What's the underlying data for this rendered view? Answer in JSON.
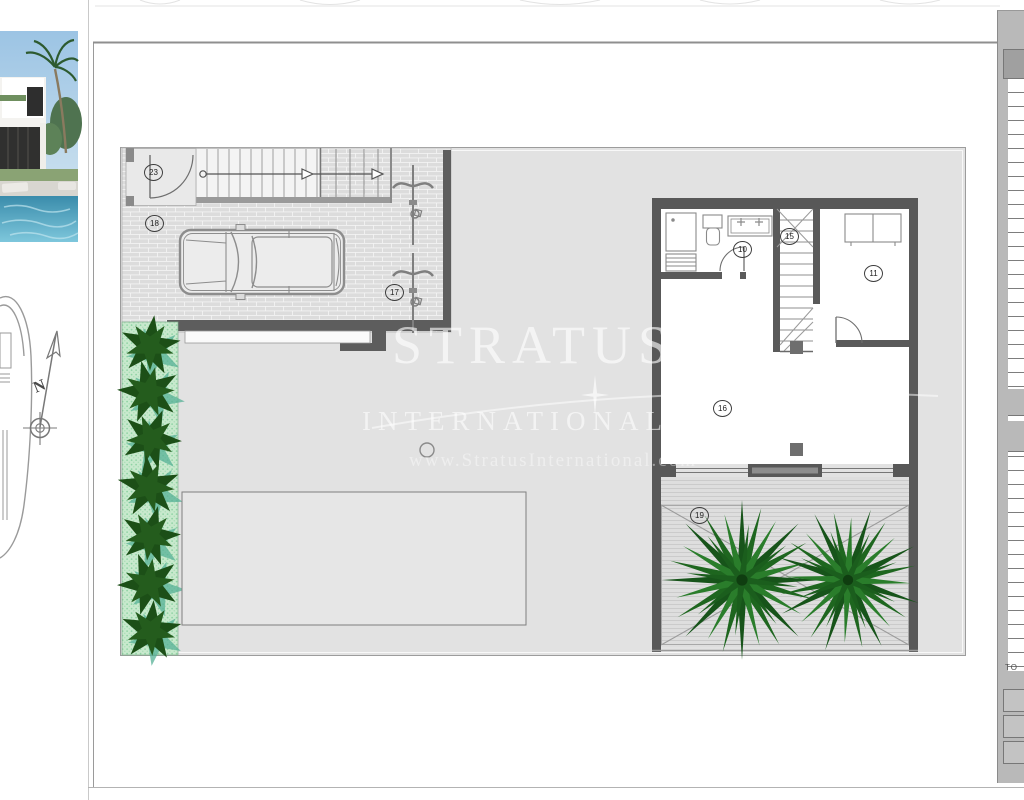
{
  "watermark": {
    "line1": "STRATUS",
    "line2": "INTERNATIONAL",
    "line3": "www.StratusInternational.com"
  },
  "compass": {
    "north_label": "N"
  },
  "plan": {
    "labels": [
      {
        "id": "23"
      },
      {
        "id": "18"
      },
      {
        "id": "17"
      },
      {
        "id": "10"
      },
      {
        "id": "15"
      },
      {
        "id": "11"
      },
      {
        "id": "16"
      },
      {
        "id": "19"
      }
    ]
  },
  "side_table": {
    "fragment": "TO"
  },
  "colors": {
    "wall": "#5d5d5d",
    "plot_fill": "#e2e2e2",
    "hedge_green": "#1c4f17",
    "palm_green": "#1e661f",
    "pool_photo_blue": "#4aa0bf"
  }
}
